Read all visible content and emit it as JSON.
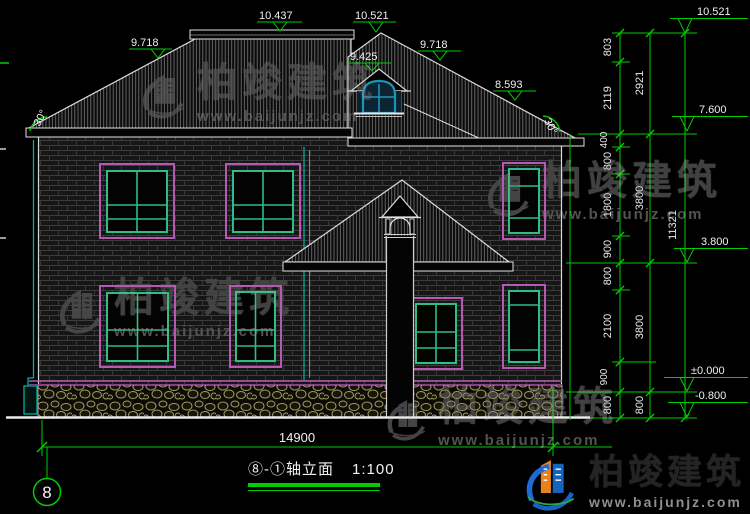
{
  "watermark": {
    "text": "柏竣建筑",
    "url": "www.baijunjz.com"
  },
  "brand": {
    "name": "柏竣建筑",
    "url": "www.baijunjz.com"
  },
  "titleblock": {
    "title": "⑧-①轴立面",
    "scale": "1:100",
    "axis_bubble": "8"
  },
  "dims": {
    "overall_width": "14900",
    "inner": [
      "803",
      "2119",
      "400",
      "800",
      "1800",
      "900",
      "800",
      "2100",
      "900",
      "800"
    ],
    "middle": [
      "2921",
      "3800",
      "3800",
      "800"
    ],
    "outer": "11321"
  },
  "elevations": {
    "roof": [
      "9.718",
      "10.437",
      "10.521",
      "9.425",
      "9.718",
      "8.593"
    ],
    "right": [
      "10.521",
      "7.600",
      "3.800",
      "±0.000",
      "-0.800"
    ]
  },
  "angles": {
    "left": "30°",
    "right": "30°"
  },
  "colors": {
    "annotation_green": "#00cc00",
    "line_white": "#e8e8e8",
    "window_magenta": "#b45ab4",
    "window_teal": "#2dbd85",
    "dormer_blue": "#1f93b4",
    "stone_khaki": "#a39a62",
    "cyan_accent": "#00b2a2",
    "brand_blue": "#1565c0",
    "brand_orange": "#e8821e"
  }
}
